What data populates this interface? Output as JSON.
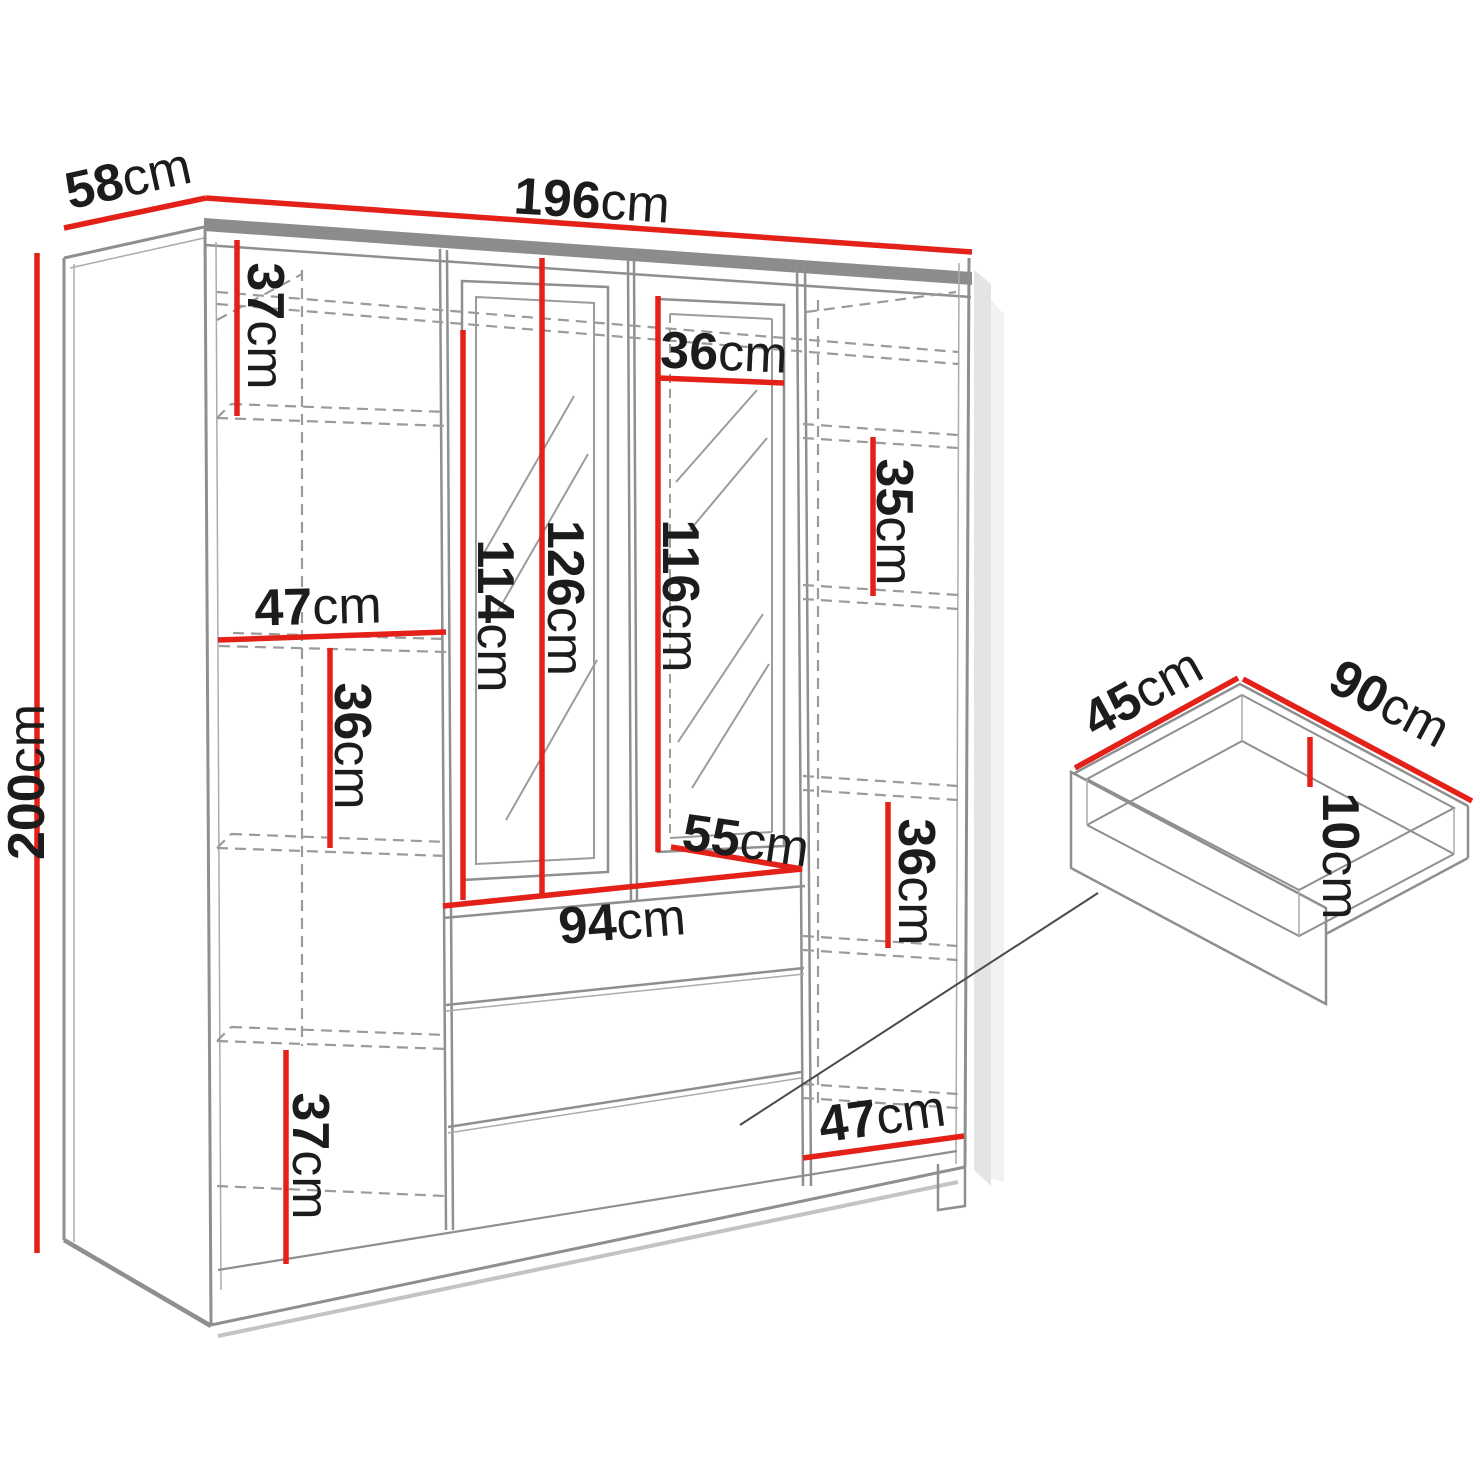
{
  "title": "Wardrobe dimension diagram",
  "unit": "cm",
  "colors": {
    "dimension_red": "#e32119",
    "outline_gray": "#8f8f8f",
    "dashed_gray": "#9b9b9b",
    "text": "#1c1c1c",
    "background": "#ffffff"
  },
  "wardrobe": {
    "overall": {
      "width": "196",
      "depth": "58",
      "height": "200"
    },
    "left_column": {
      "top_section_height": "37",
      "inner_width": "47",
      "middle_section_height": "36",
      "bottom_section_height": "37"
    },
    "center": {
      "left_mirror_height": "114",
      "center_height": "126",
      "right_mirror_height": "116",
      "right_door_width": "36",
      "interior_depth": "55",
      "drawer_section_width": "94"
    },
    "right_column": {
      "upper_section_height": "35",
      "lower_section_height": "36",
      "inner_width": "47"
    }
  },
  "drawer_detail": {
    "depth": "45",
    "width": "90",
    "height": "10"
  }
}
